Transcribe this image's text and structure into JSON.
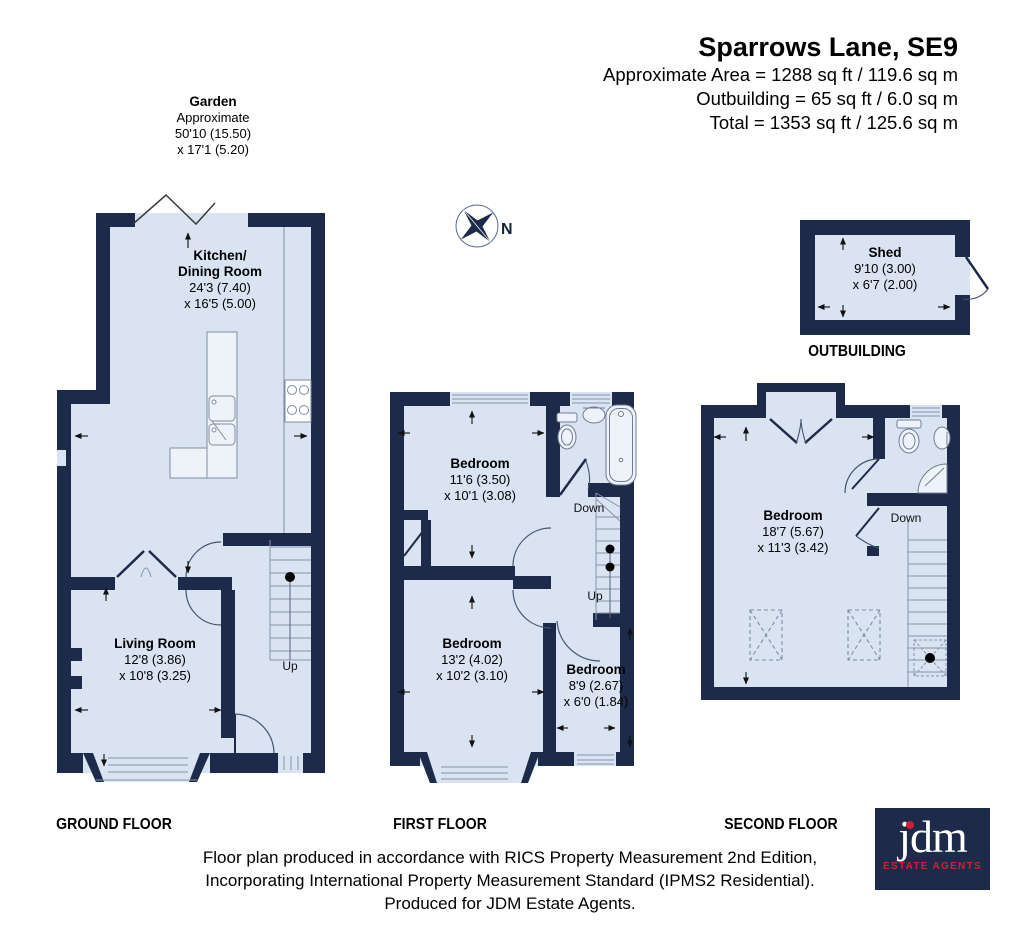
{
  "header": {
    "title": "Sparrows Lane, SE9",
    "area_lines": [
      "Approximate Area = 1288 sq ft / 119.6 sq m",
      "Outbuilding = 65 sq ft / 6.0 sq m",
      "Total = 1353 sq ft / 125.6 sq m"
    ]
  },
  "garden": {
    "name": "Garden",
    "note": "Approximate",
    "dim1": "50'10 (15.50)",
    "dim2": "x 17'1 (5.20)"
  },
  "compass": {
    "north_label": "N"
  },
  "ground_floor": {
    "caption": "GROUND FLOOR",
    "kitchen": {
      "name_line1": "Kitchen/",
      "name_line2": "Dining Room",
      "dim1": "24'3 (7.40)",
      "dim2": "x 16'5 (5.00)"
    },
    "living": {
      "name": "Living Room",
      "dim1": "12'8 (3.86)",
      "dim2": "x 10'8 (3.25)"
    },
    "stairs_up": "Up"
  },
  "first_floor": {
    "caption": "FIRST FLOOR",
    "bedroom1": {
      "name": "Bedroom",
      "dim1": "11'6 (3.50)",
      "dim2": "x 10'1 (3.08)"
    },
    "bedroom2": {
      "name": "Bedroom",
      "dim1": "13'2 (4.02)",
      "dim2": "x 10'2 (3.10)"
    },
    "bedroom3": {
      "name": "Bedroom",
      "dim1": "8'9 (2.67)",
      "dim2": "x 6'0 (1.84)"
    },
    "stairs_down": "Down",
    "stairs_up": "Up"
  },
  "second_floor": {
    "caption": "SECOND FLOOR",
    "bedroom": {
      "name": "Bedroom",
      "dim1": "18'7 (5.67)",
      "dim2": "x 11'3 (3.42)"
    },
    "stairs_down": "Down"
  },
  "outbuilding": {
    "caption": "OUTBUILDING",
    "shed": {
      "name": "Shed",
      "dim1": "9'10 (3.00)",
      "dim2": "x 6'7 (2.00)"
    }
  },
  "footer": {
    "lines": [
      "Floor plan produced in accordance with RICS Property Measurement 2nd Edition,",
      "Incorporating International Property Measurement Standard (IPMS2 Residential).",
      "Produced for JDM Estate Agents."
    ]
  },
  "logo": {
    "brand": "jdm",
    "tagline": "ESTATE AGENTS"
  },
  "colors": {
    "wall": "#1e2a4a",
    "floor_fill": "#d9e3f1",
    "logo_red": "#d0202e"
  }
}
